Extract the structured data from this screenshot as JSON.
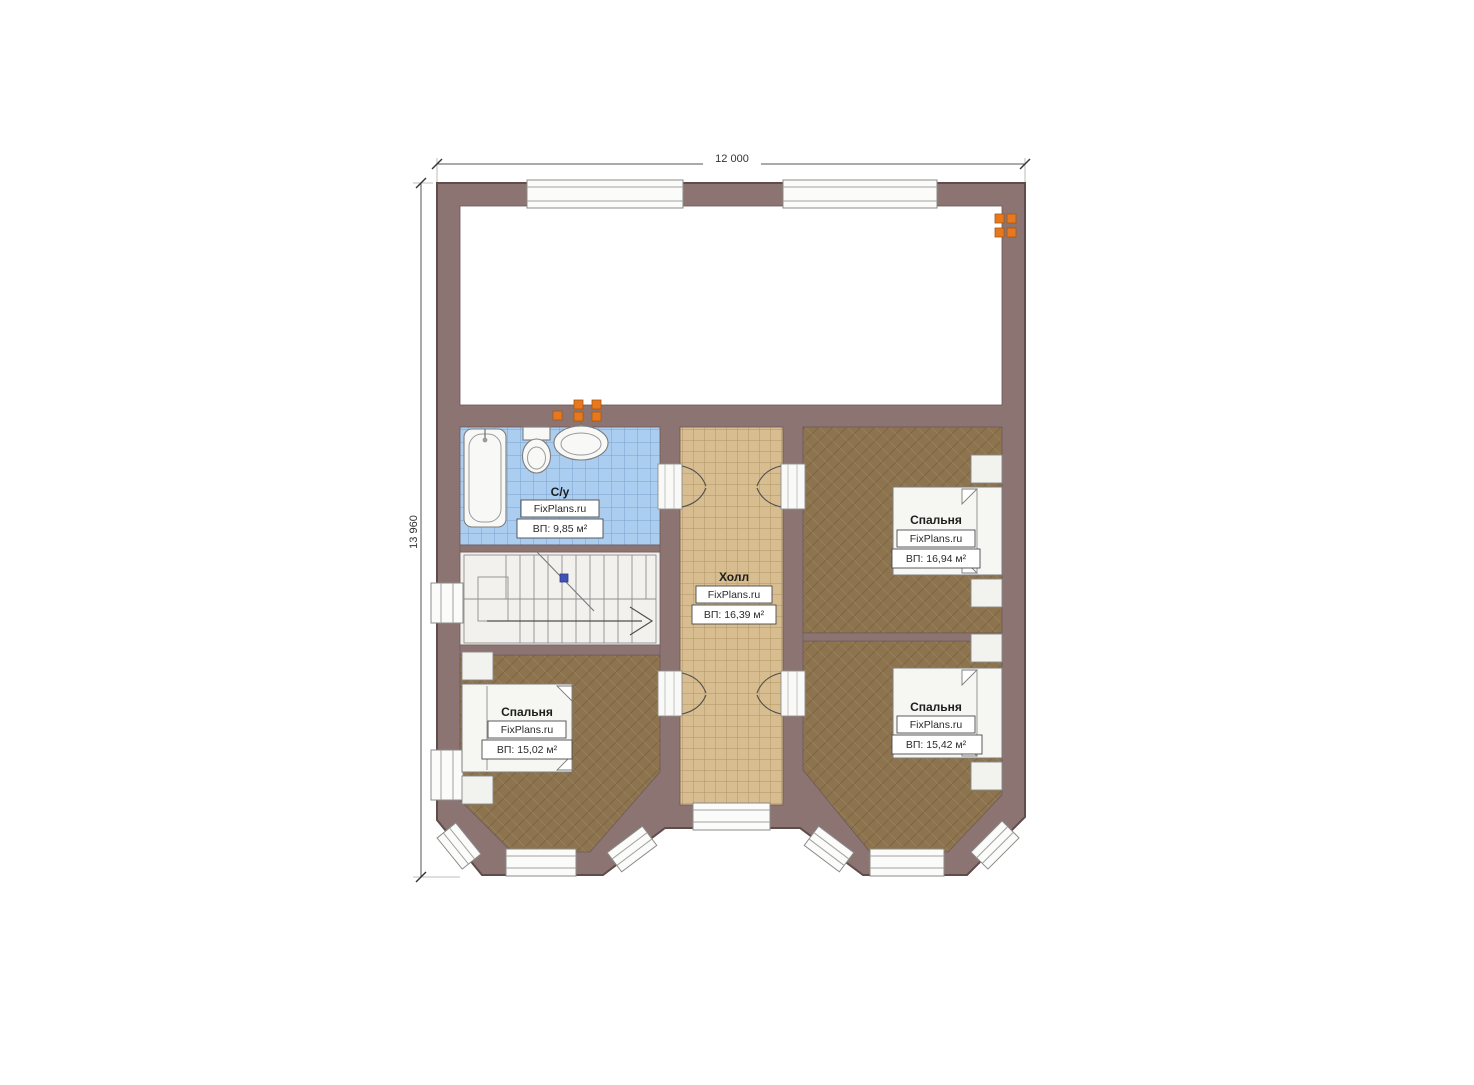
{
  "dimensions": {
    "top": "12 000",
    "left": "13 960"
  },
  "rooms": {
    "bathroom": {
      "name": "С/у",
      "watermark": "FixPlans.ru",
      "area": "ВП: 9,85 м²"
    },
    "hall": {
      "name": "Холл",
      "watermark": "FixPlans.ru",
      "area": "ВП: 16,39 м²"
    },
    "bedroom_top_right": {
      "name": "Спальня",
      "watermark": "FixPlans.ru",
      "area": "ВП: 16,94 м²"
    },
    "bedroom_bottom_left": {
      "name": "Спальня",
      "watermark": "FixPlans.ru",
      "area": "ВП: 15,02 м²"
    },
    "bedroom_bottom_right": {
      "name": "Спальня",
      "watermark": "FixPlans.ru",
      "area": "ВП: 15,42 м²"
    }
  },
  "colors": {
    "wall": "#8c7472",
    "bathroom_tile": "#abcdf0",
    "hall_tile": "#d7bd8f",
    "bedroom_floor": "#8d744e",
    "stair_floor": "#f2f1ee",
    "radiator": "#e8781e"
  }
}
